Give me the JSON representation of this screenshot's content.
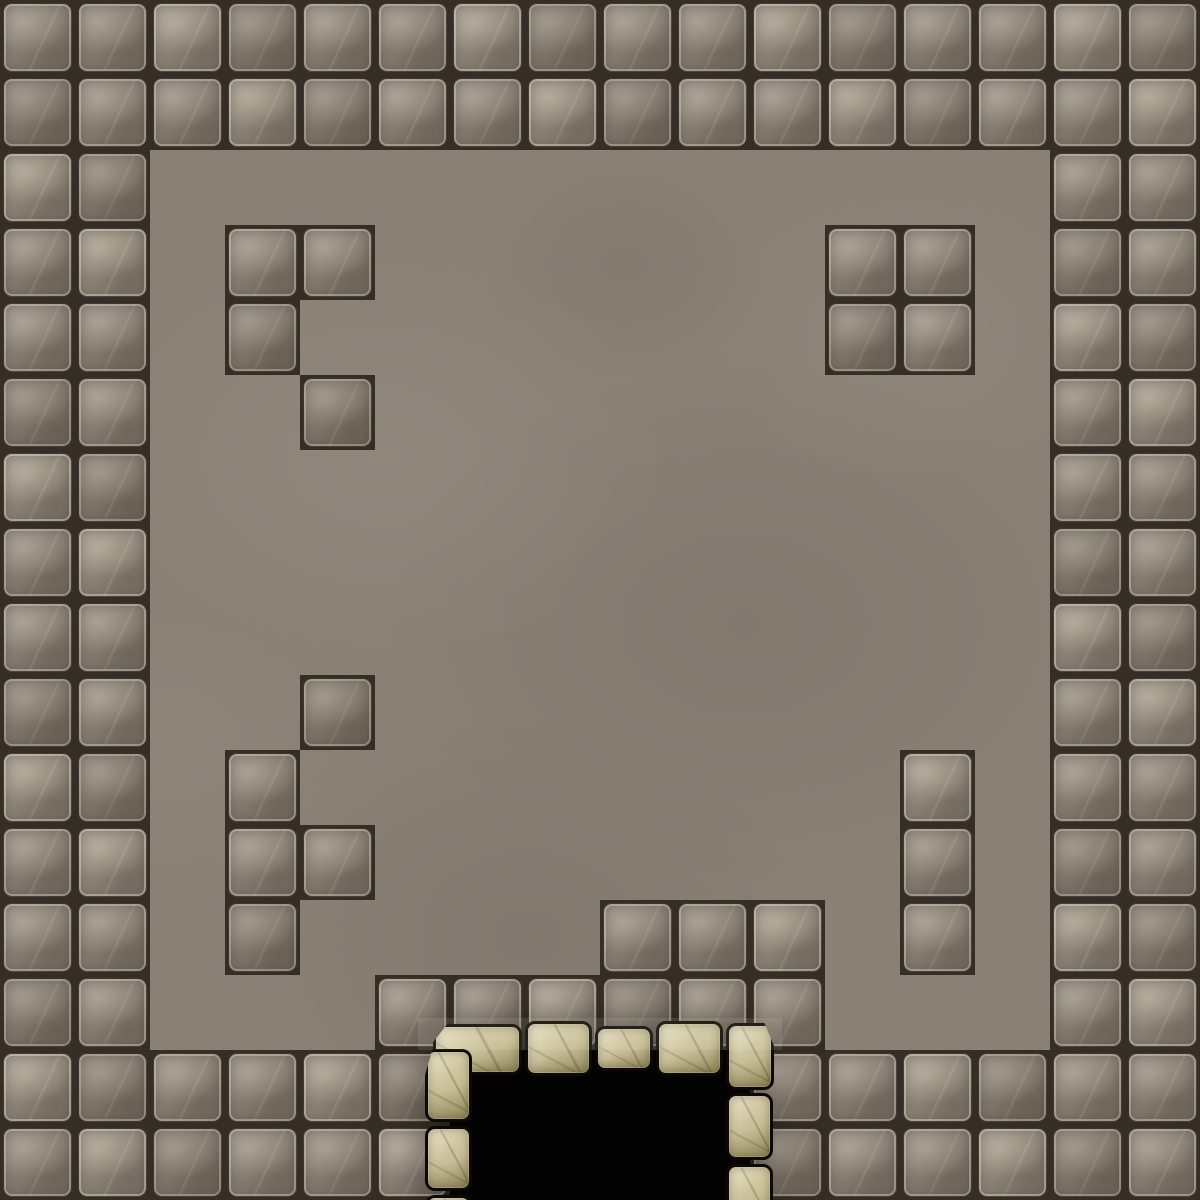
{
  "scene": {
    "name": "dungeon-stone-room-map",
    "viewport": {
      "width": 1200,
      "height": 1200
    },
    "grid": {
      "cols": 16,
      "rows": 16,
      "tile_size": 75
    },
    "tile_legend": {
      "W": "stone-brick-tile",
      ".": "smooth-floor",
      "D": "doorway-void"
    },
    "map_rows": [
      "WWWWWWWWWWWWWWWW",
      "WWWWWWWWWWWWWWWW",
      "WW............WW",
      "WW.WW......WW.WW",
      "WW.W.......WW.WW",
      "WW..W.........WW",
      "WW............WW",
      "WW............WW",
      "WW............WW",
      "WW..W.........WW",
      "WW.W........W.WW",
      "WW.WW.......W.WW",
      "WW.W....WWW.W.WW",
      "WW...WWWWWW...WW",
      "WWWWWWDDDDWWWWWW",
      "WWWWWWDDDDWWWWWW"
    ],
    "palette": {
      "mortar": "#352e26",
      "brick_base": "#8f8679",
      "brick_light": "#a89f91",
      "brick_dark": "#6f675c",
      "brick_edge_highlight": "rgba(232,224,206,0.40)",
      "floor_base": "#8a8076",
      "door_stone_base": "#c7bd96",
      "door_stone_light": "#e0d8b2",
      "door_stone_dark": "#8d8456",
      "door_outline": "#0d0a05",
      "void_black": "#030303"
    },
    "door": {
      "void": {
        "x": 466,
        "y": 1068,
        "w": 264,
        "h": 132
      },
      "light_band": {
        "x": 418,
        "y": 1018,
        "w": 364,
        "h": 32
      },
      "stones": [
        {
          "x": 433,
          "y": 1024,
          "w": 89,
          "h": 51,
          "shape": "cut-tl",
          "part": "lintel"
        },
        {
          "x": 525,
          "y": 1021,
          "w": 67,
          "h": 55,
          "shape": "",
          "part": "lintel"
        },
        {
          "x": 595,
          "y": 1026,
          "w": 58,
          "h": 45,
          "shape": "",
          "part": "lintel"
        },
        {
          "x": 656,
          "y": 1021,
          "w": 67,
          "h": 55,
          "shape": "",
          "part": "lintel"
        },
        {
          "x": 726,
          "y": 1023,
          "w": 48,
          "h": 67,
          "shape": "cut-tr",
          "part": "lintel"
        },
        {
          "x": 425,
          "y": 1049,
          "w": 47,
          "h": 73,
          "shape": "cut-tl",
          "part": "left-jamb"
        },
        {
          "x": 425,
          "y": 1126,
          "w": 47,
          "h": 65,
          "shape": "",
          "part": "left-jamb"
        },
        {
          "x": 425,
          "y": 1195,
          "w": 47,
          "h": 45,
          "shape": "",
          "part": "left-jamb"
        },
        {
          "x": 726,
          "y": 1093,
          "w": 47,
          "h": 67,
          "shape": "",
          "part": "right-jamb"
        },
        {
          "x": 726,
          "y": 1164,
          "w": 47,
          "h": 66,
          "shape": "",
          "part": "right-jamb"
        }
      ]
    }
  }
}
